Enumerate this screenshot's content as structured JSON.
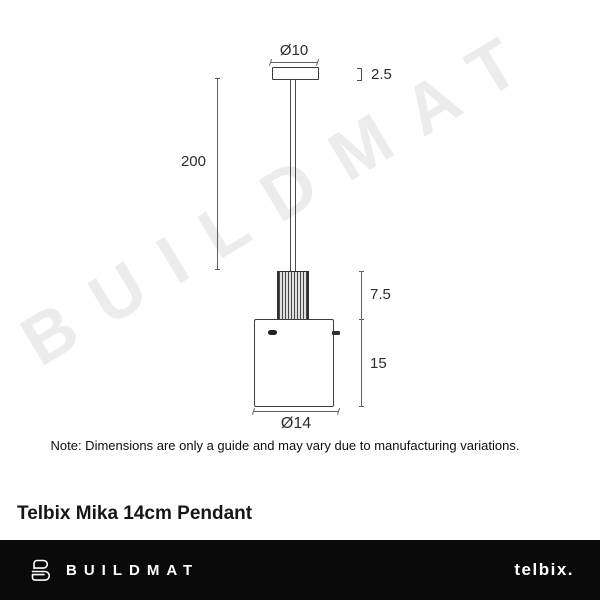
{
  "watermark": {
    "text": "BUILDMAT"
  },
  "diagram": {
    "labels": {
      "canopy_diameter": "Ø10",
      "canopy_height": "2.5",
      "cord_length": "200",
      "neck_height": "7.5",
      "shade_height": "15",
      "shade_diameter": "Ø14"
    },
    "note": "Note: Dimensions are only a guide and may vary due to manufacturing variations."
  },
  "product": {
    "title": "Telbix Mika 14cm Pendant"
  },
  "footer": {
    "brand": "BUILDMAT",
    "supplier_logo": "telbix."
  },
  "colors": {
    "line": "#4a4a4a",
    "watermark": "#ececec",
    "footer_bg": "#0a0a0a",
    "text": "#161616"
  }
}
